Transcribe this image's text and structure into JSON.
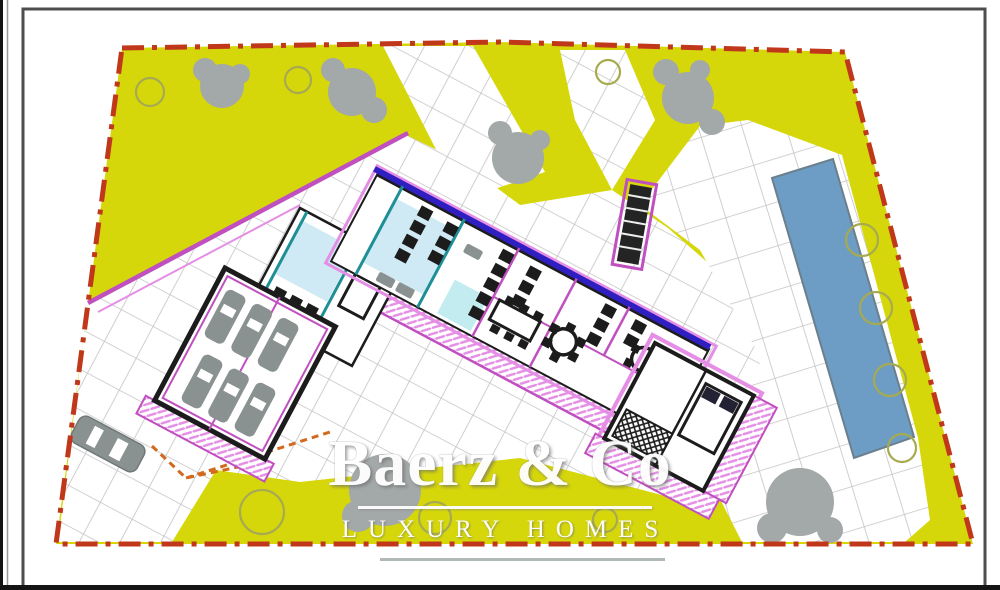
{
  "watermark": {
    "brand": "Baerz & Co",
    "tagline": "LUXURY HOMES"
  },
  "theme": {
    "site_yellow": "#d6d70a",
    "boundary_red": "#c0371a",
    "pool_blue": "#6d9dc5",
    "grid_gray": "#c3c3c3",
    "wall_magenta": "#c050c0",
    "deck_pink": "#e58ee5",
    "wall_black": "#1c1c1c",
    "line_blue": "#2f1fc0",
    "teal": "#1e8f96",
    "room_blue": "#cfeaf4",
    "tree_gray": "#a3a8a8",
    "tree_outline": "#a6aa50",
    "car_gray": "#8a9191",
    "frame_gray": "#4d4d4d",
    "watermark_white": "#ffffff",
    "rule_gray": "#a9b0b0",
    "arrow_orange": "#d2691e"
  }
}
